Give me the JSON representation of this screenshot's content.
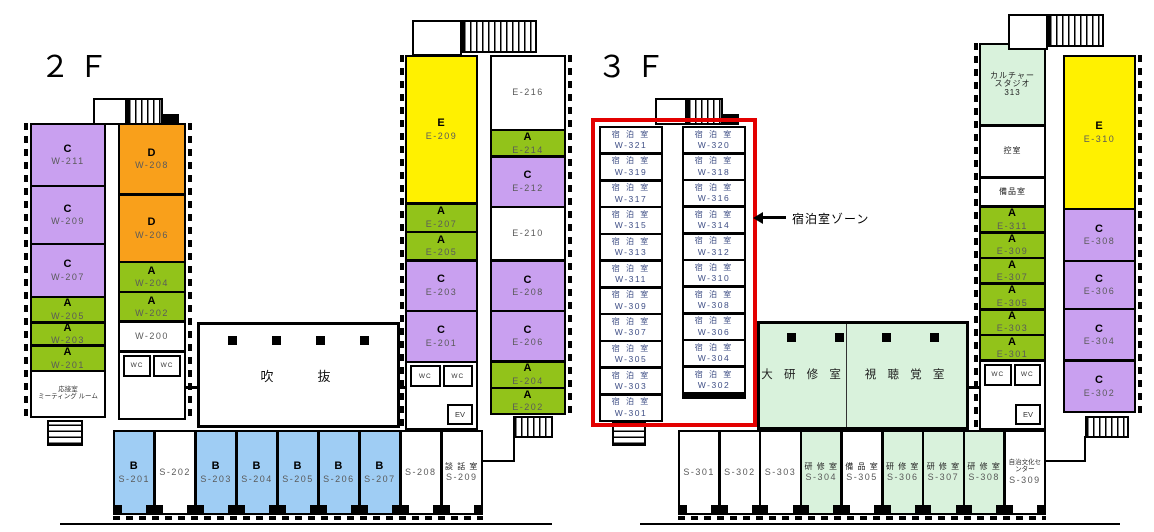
{
  "palette": {
    "type_a_green": "#92C31A",
    "type_b_blue": "#9FCDF4",
    "type_c_purple": "#C9A0F0",
    "type_d_orange": "#F9A01B",
    "type_e_yellow": "#FFF100",
    "hall_light_green": "#D9F2DC",
    "lodging_zone_red": "#E30000",
    "wall_black": "#000000"
  },
  "labels": {
    "wc": "WC",
    "ev": "EV"
  },
  "floor2f": {
    "title": "２Ｆ",
    "atrium_label": "吹　　抜",
    "west_left": [
      {
        "t": "C",
        "c": "W-211",
        "f": "purple",
        "h": 26
      },
      {
        "t": "C",
        "c": "W-209",
        "f": "purple",
        "h": 24
      },
      {
        "t": "C",
        "c": "W-207",
        "f": "purple",
        "h": 22
      },
      {
        "t": "A",
        "c": "W-205",
        "f": "green",
        "h": 10
      },
      {
        "t": "A",
        "c": "W-203",
        "f": "green",
        "h": 9
      },
      {
        "t": "A",
        "c": "W-201",
        "f": "green",
        "h": 10
      },
      {
        "t": "応接室\nミーティング ルーム",
        "f": "white",
        "h": 19,
        "cls": "tiny"
      }
    ],
    "west_right": [
      {
        "t": "D",
        "c": "W-208",
        "f": "orange",
        "h": 25
      },
      {
        "t": "D",
        "c": "W-206",
        "f": "orange",
        "h": 24
      },
      {
        "t": "A",
        "c": "W-204",
        "f": "green",
        "h": 10
      },
      {
        "t": "A",
        "c": "W-202",
        "f": "green",
        "h": 10
      },
      {
        "c": "W-200",
        "f": "white",
        "h": 10
      },
      {
        "wc": true,
        "f": "white",
        "h": 24
      }
    ],
    "east_left": [
      {
        "t": "E",
        "c": "E-209",
        "f": "yellow",
        "h": 45
      },
      {
        "t": "A",
        "c": "E-207",
        "f": "green",
        "h": 8
      },
      {
        "t": "A",
        "c": "E-205",
        "f": "green",
        "h": 8
      },
      {
        "t": "C",
        "c": "E-203",
        "f": "purple",
        "h": 15
      },
      {
        "t": "C",
        "c": "E-201",
        "f": "purple",
        "h": 15
      },
      {
        "wc": true,
        "ev": true,
        "f": "white",
        "h": 20
      }
    ],
    "east_right": [
      {
        "c": "E-216",
        "f": "white",
        "h": 21
      },
      {
        "t": "A",
        "c": "E-214",
        "f": "green",
        "h": 7
      },
      {
        "t": "C",
        "c": "E-212",
        "f": "purple",
        "h": 14
      },
      {
        "c": "E-210",
        "f": "white",
        "h": 15
      },
      {
        "t": "C",
        "c": "E-208",
        "f": "purple",
        "h": 14
      },
      {
        "t": "C",
        "c": "E-206",
        "f": "purple",
        "h": 14
      },
      {
        "t": "A",
        "c": "E-204",
        "f": "green",
        "h": 7
      },
      {
        "t": "A",
        "c": "E-202",
        "f": "green",
        "h": 7
      }
    ],
    "south": [
      {
        "t": "B",
        "c": "S-201",
        "f": "blue"
      },
      {
        "c": "S-202",
        "f": "white"
      },
      {
        "t": "B",
        "c": "S-203",
        "f": "blue"
      },
      {
        "t": "B",
        "c": "S-204",
        "f": "blue"
      },
      {
        "t": "B",
        "c": "S-205",
        "f": "blue"
      },
      {
        "t": "B",
        "c": "S-206",
        "f": "blue"
      },
      {
        "t": "B",
        "c": "S-207",
        "f": "blue"
      },
      {
        "c": "S-208",
        "f": "white"
      },
      {
        "t": "談 話 室",
        "c": "S-209",
        "f": "white",
        "cls": "small"
      }
    ]
  },
  "floor3f": {
    "title": "３Ｆ",
    "zone_label": "宿泊室ゾーン",
    "west_left": [
      {
        "t": "宿 泊 室",
        "c": "W-321",
        "f": "white",
        "cls": "lodge"
      },
      {
        "t": "宿 泊 室",
        "c": "W-319",
        "f": "white",
        "cls": "lodge"
      },
      {
        "t": "宿 泊 室",
        "c": "W-317",
        "f": "white",
        "cls": "lodge"
      },
      {
        "t": "宿 泊 室",
        "c": "W-315",
        "f": "white",
        "cls": "lodge"
      },
      {
        "t": "宿 泊 室",
        "c": "W-313",
        "f": "white",
        "cls": "lodge"
      },
      {
        "t": "宿 泊 室",
        "c": "W-311",
        "f": "white",
        "cls": "lodge"
      },
      {
        "t": "宿 泊 室",
        "c": "W-309",
        "f": "white",
        "cls": "lodge"
      },
      {
        "t": "宿 泊 室",
        "c": "W-307",
        "f": "white",
        "cls": "lodge"
      },
      {
        "t": "宿 泊 室",
        "c": "W-305",
        "f": "white",
        "cls": "lodge"
      },
      {
        "t": "宿 泊 室",
        "c": "W-303",
        "f": "white",
        "cls": "lodge"
      },
      {
        "t": "宿 泊 室",
        "c": "W-301",
        "f": "white",
        "cls": "lodge"
      }
    ],
    "west_right": [
      {
        "t": "宿 泊 室",
        "c": "W-320",
        "f": "white",
        "cls": "lodge"
      },
      {
        "t": "宿 泊 室",
        "c": "W-318",
        "f": "white",
        "cls": "lodge"
      },
      {
        "t": "宿 泊 室",
        "c": "W-316",
        "f": "white",
        "cls": "lodge"
      },
      {
        "t": "宿 泊 室",
        "c": "W-314",
        "f": "white",
        "cls": "lodge"
      },
      {
        "t": "宿 泊 室",
        "c": "W-312",
        "f": "white",
        "cls": "lodge"
      },
      {
        "t": "宿 泊 室",
        "c": "W-310",
        "f": "white",
        "cls": "lodge"
      },
      {
        "t": "宿 泊 室",
        "c": "W-308",
        "f": "white",
        "cls": "lodge"
      },
      {
        "t": "宿 泊 室",
        "c": "W-306",
        "f": "white",
        "cls": "lodge"
      },
      {
        "t": "宿 泊 室",
        "c": "W-304",
        "f": "white",
        "cls": "lodge"
      },
      {
        "t": "宿 泊 室",
        "c": "W-302",
        "f": "white",
        "cls": "lodge"
      }
    ],
    "center": [
      {
        "t": "大 研 修 室",
        "f": "ltgreen",
        "h": 42,
        "cls": "hall"
      },
      {
        "t": "視 聴 覚 室",
        "f": "ltgreen",
        "h": 58,
        "cls": "hall"
      }
    ],
    "east_left": [
      {
        "t": "カルチャー\nスタジオ\n313",
        "f": "ltgreen",
        "h": 24,
        "cls": "small"
      },
      {
        "t": "控室",
        "f": "white",
        "h": 15,
        "cls": "small"
      },
      {
        "t": "備品室",
        "f": "white",
        "h": 8,
        "cls": "small"
      },
      {
        "t": "A",
        "c": "E-311",
        "f": "green",
        "h": 7
      },
      {
        "t": "A",
        "c": "E-309",
        "f": "green",
        "h": 7
      },
      {
        "t": "A",
        "c": "E-307",
        "f": "green",
        "h": 7
      },
      {
        "t": "A",
        "c": "E-305",
        "f": "green",
        "h": 7
      },
      {
        "t": "A",
        "c": "E-303",
        "f": "green",
        "h": 7
      },
      {
        "t": "A",
        "c": "E-301",
        "f": "green",
        "h": 7
      },
      {
        "wc": true,
        "ev": true,
        "f": "white",
        "h": 20
      }
    ],
    "east_right": [
      {
        "t": "E",
        "c": "E-310",
        "f": "yellow",
        "h": 43
      },
      {
        "t": "C",
        "c": "E-308",
        "f": "purple",
        "h": 14
      },
      {
        "t": "C",
        "c": "E-306",
        "f": "purple",
        "h": 13
      },
      {
        "t": "C",
        "c": "E-304",
        "f": "purple",
        "h": 14
      },
      {
        "t": "C",
        "c": "E-302",
        "f": "purple",
        "h": 14
      }
    ],
    "south": [
      {
        "c": "S-301",
        "f": "white"
      },
      {
        "c": "S-302",
        "f": "white"
      },
      {
        "c": "S-303",
        "f": "white"
      },
      {
        "t": "研 修 室",
        "c": "S-304",
        "f": "ltgreen",
        "cls": "small"
      },
      {
        "t": "備 品 室",
        "c": "S-305",
        "f": "white",
        "cls": "small"
      },
      {
        "t": "研 修 室",
        "c": "S-306",
        "f": "ltgreen",
        "cls": "small"
      },
      {
        "t": "研 修 室",
        "c": "S-307",
        "f": "ltgreen",
        "cls": "small"
      },
      {
        "t": "研 修 室",
        "c": "S-308",
        "f": "ltgreen",
        "cls": "small"
      },
      {
        "t": "自治文化センター",
        "c": "S-309",
        "f": "white",
        "cls": "tiny"
      }
    ]
  }
}
